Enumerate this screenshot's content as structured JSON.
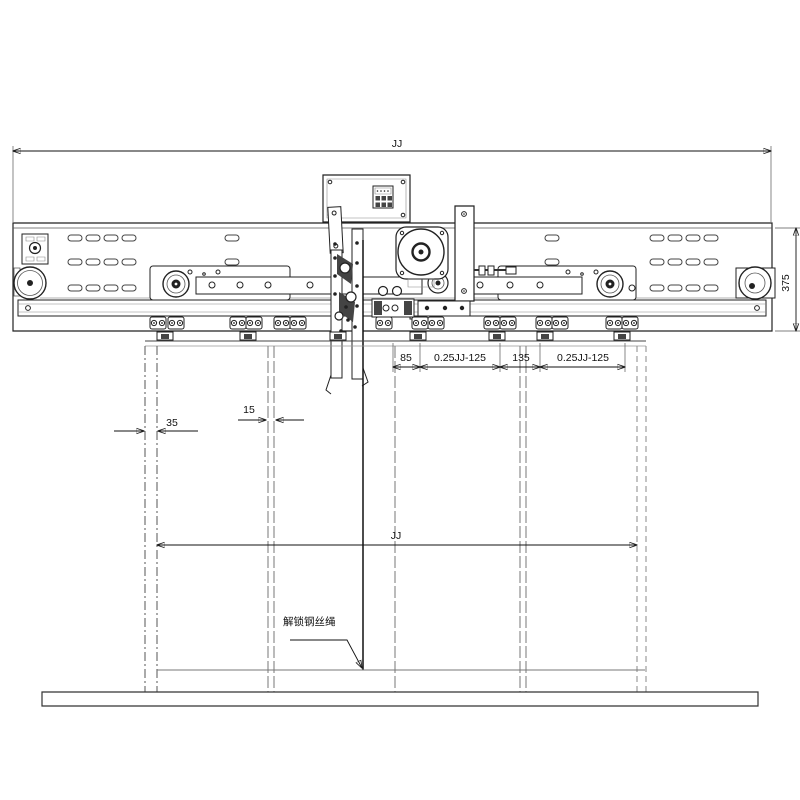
{
  "dims": {
    "top_width": "JJ",
    "header_height": "375",
    "seg_85": "85",
    "seg_quarter_1": "0.25JJ-125",
    "seg_135": "135",
    "seg_quarter_2": "0.25JJ-125",
    "gap_35": "35",
    "thickness_15": "15",
    "opening_width": "JJ"
  },
  "callouts": {
    "unlock_rope": "解锁钢丝绳"
  }
}
